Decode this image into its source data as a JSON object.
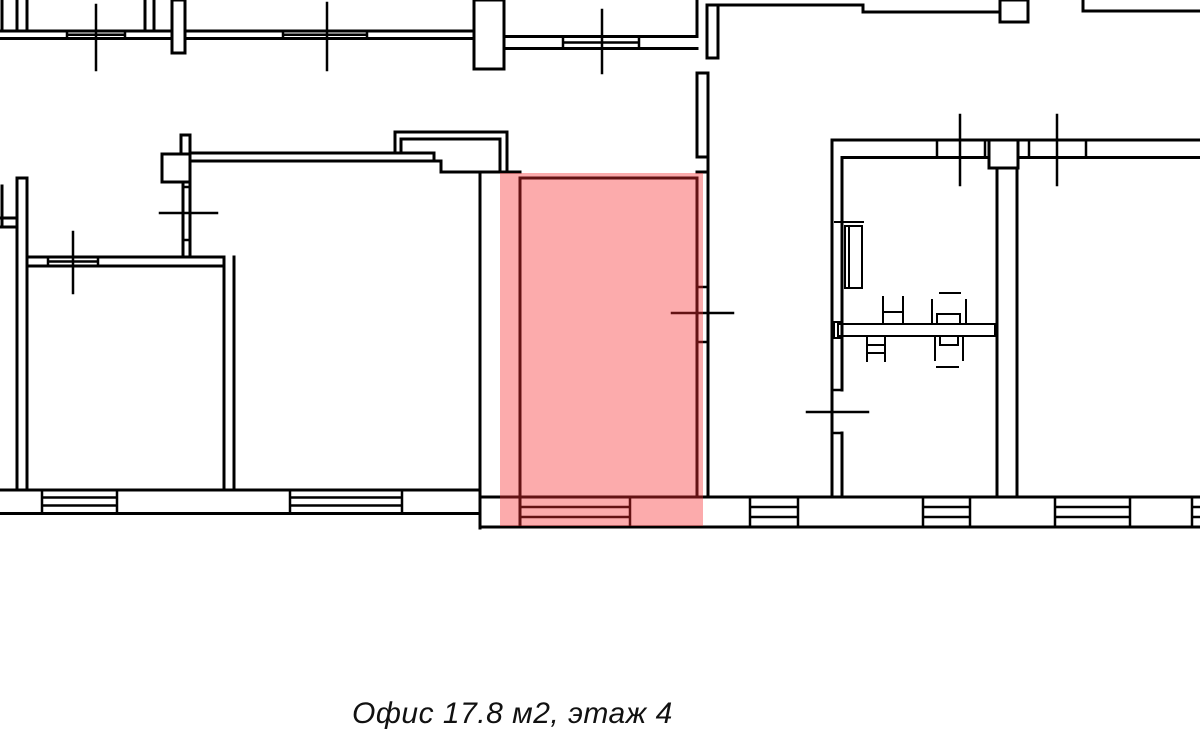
{
  "meta": {
    "background_color": "#ffffff",
    "line_color": "#000000"
  },
  "floor_plan": {
    "caption": "Офис 17.8 м2, этаж 4",
    "office_label": "Офис",
    "area_m2": "17.8",
    "floor": "4",
    "highlight_color": "#f82d30",
    "highlight_opacity": "0.4"
  }
}
